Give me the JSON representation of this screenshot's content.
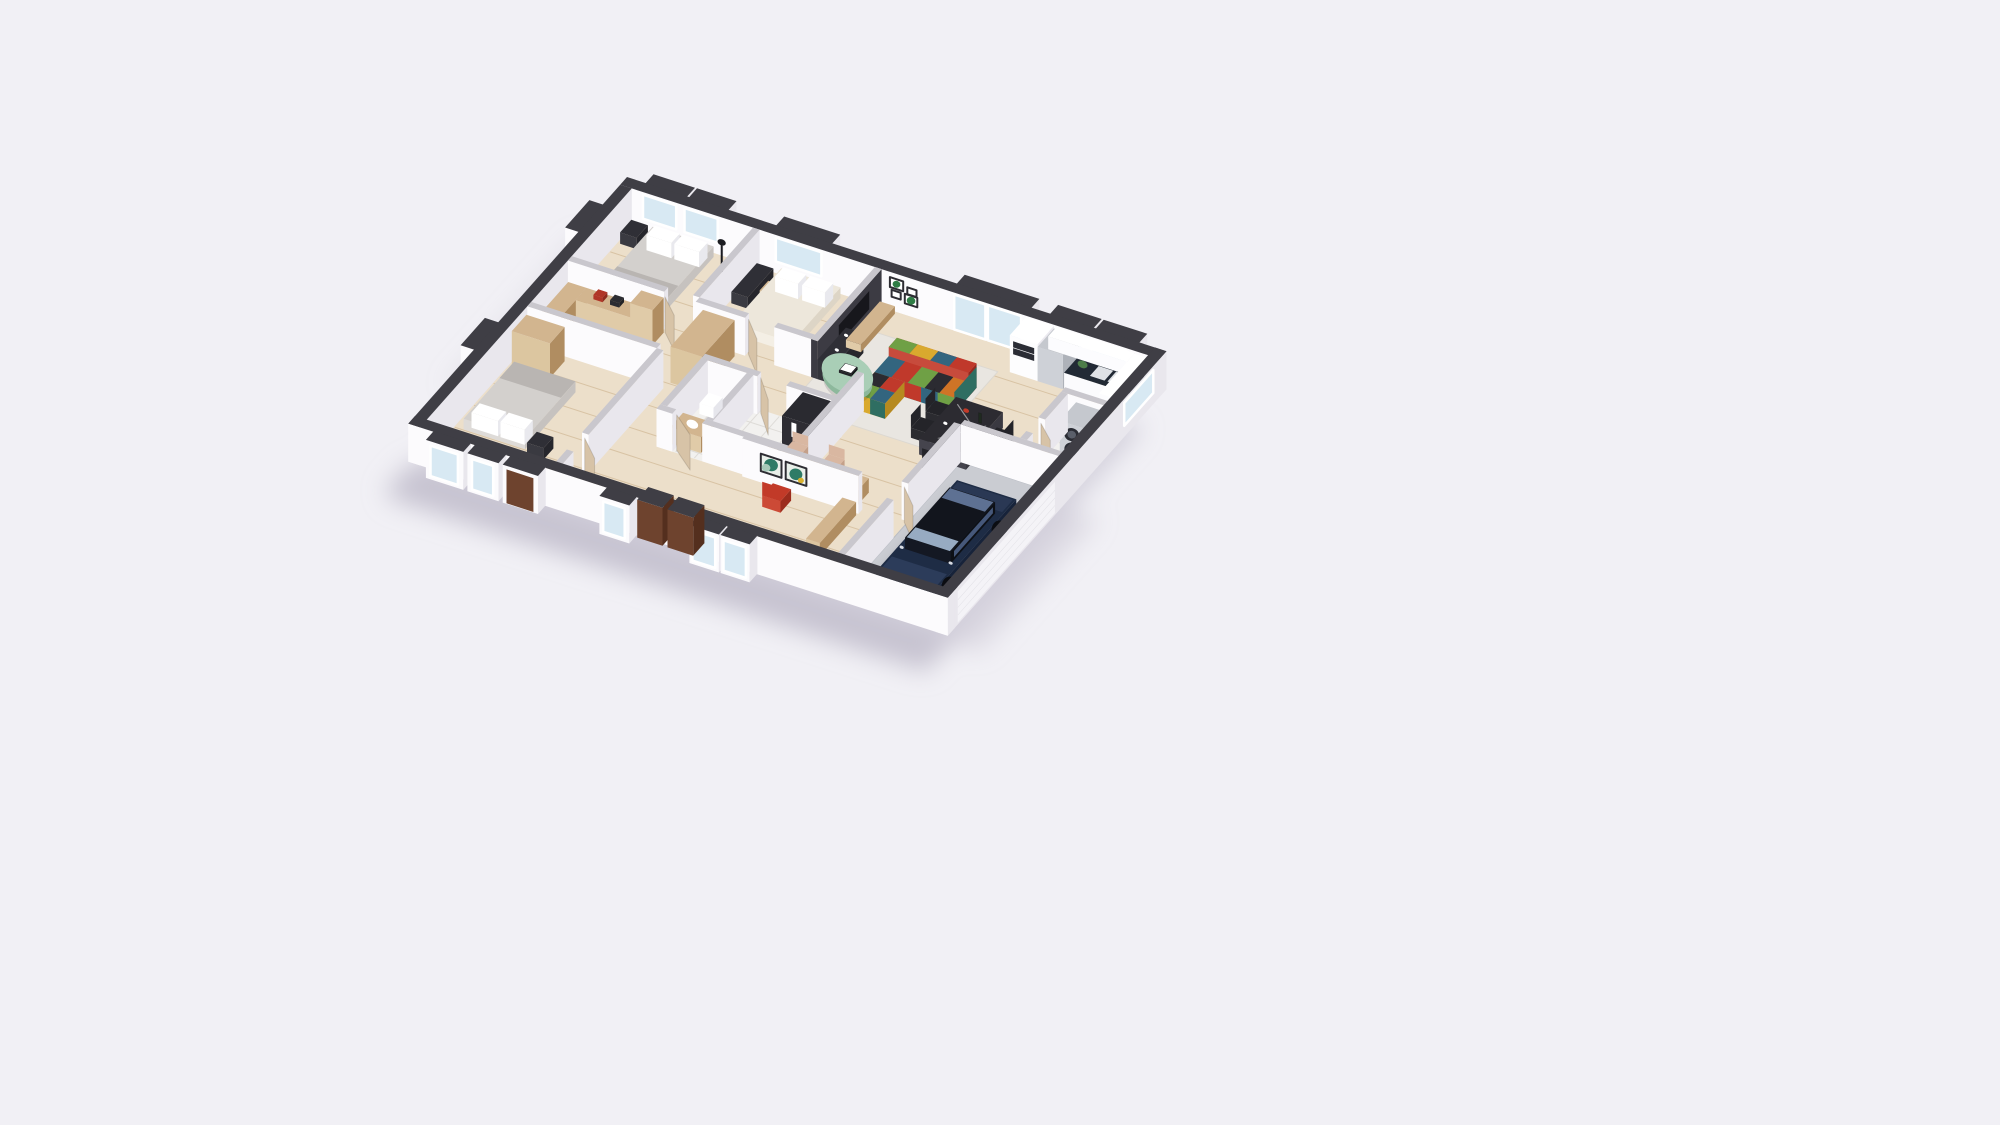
{
  "scene": {
    "type": "3d-floorplan-dollhouse-render",
    "background": "#f1f0f5",
    "light_direction": "upper-right",
    "shadow_color": "#b9b5c6"
  },
  "palette": {
    "bg": "#f1f0f5",
    "shadow": "#b9b5c6",
    "extTop": "#3f3e45",
    "intTop": "#c9c7cd",
    "wallA": "#e9e7ed",
    "wallB": "#fcfbfd",
    "floorWood": "#ecdfca",
    "floorWoodLine": "#d8c3a4",
    "floorTile": "#f2f1ef",
    "tileLine": "#dedcd8",
    "floorGarage": "#caccd2",
    "rug": "#e9e6e1",
    "glass": "#d8e9f3",
    "glassFrame": "#ffffff",
    "tvWall": "#3c3b43",
    "tvScreen": "#17171c",
    "mediaDark": "#2f2f36",
    "wood": "#d2b58f",
    "woodDark": "#b08d61",
    "woodDoor": "#d7c3a7",
    "doorBrown": "#6e432e",
    "doorDark": "#542f1e",
    "duvet": "#d3d0cd",
    "duvetDark": "#b9b5b2",
    "cream": "#ede7db",
    "white": "#ffffff",
    "counterDark": "#222a35",
    "appliance": "#c5c8ce",
    "applianceDark": "#2b2d35",
    "mint": "#a9ceb6",
    "mintDark": "#8db89c",
    "tableTop": "#2c2b31",
    "tableSide": "#3a3941",
    "chairBlack": "#242429",
    "beige": "#d9b7a1",
    "redChair": "#c23a28",
    "carBody": "#1e2c45",
    "carDark": "#12151d",
    "carGlass": "#97abc2",
    "showerDark": "#242329",
    "artTeal": "#2e7b66",
    "artTealLight": "#a7c8b8",
    "artGreen": "#2f7d45",
    "artMustard": "#d8b02e"
  },
  "sofa_colors": [
    "#c0392b",
    "#3f8e80",
    "#d9a92e",
    "#33657f",
    "#6fa045",
    "#2b2b31",
    "#cf7426"
  ],
  "rooms": [
    {
      "name": "bedroom-1",
      "furniture": [
        "double-bed",
        "pillows",
        "blanket",
        "nightstand",
        "floor-lamp"
      ]
    },
    {
      "name": "bedroom-2",
      "furniture": [
        "double-bed",
        "black-desk",
        "wood-chair"
      ]
    },
    {
      "name": "walk-in-closet",
      "furniture": [
        "wood-shelving",
        "tall-wardrobe",
        "storage-boxes"
      ]
    },
    {
      "name": "hallway",
      "furniture": [
        "wardrobe-cabinet",
        "doors"
      ]
    },
    {
      "name": "bathroom",
      "furniture": [
        "black-mosaic-shower",
        "shower-fixture",
        "toilet",
        "wood-vanity"
      ]
    },
    {
      "name": "bedroom-3",
      "furniture": [
        "double-bed",
        "pillows",
        "wardrobe",
        "nightstand"
      ]
    },
    {
      "name": "living-room",
      "furniture": [
        "patchwork-sectional-sofa",
        "round-mint-coffee-table",
        "books",
        "area-rug",
        "tv-media-wall",
        "dark-shelving-unit",
        "wood-cabinet",
        "gallery-wall-frames",
        "sliding-glass-doors"
      ]
    },
    {
      "name": "kitchen",
      "furniture": [
        "oven-tower",
        "fridge",
        "counter-with-double-sink",
        "upper-cabinets",
        "plant"
      ]
    },
    {
      "name": "dining-area",
      "furniture": [
        "dark-stone-table",
        "black-chairs",
        "tableware"
      ]
    },
    {
      "name": "office-nook",
      "furniture": [
        "wood-desk",
        "beige-chairs",
        "red-office-chair",
        "abstract-art-frames",
        "wood-bench"
      ]
    },
    {
      "name": "entrance",
      "furniture": [
        "brown-double-entry-door",
        "sidelight-windows"
      ]
    },
    {
      "name": "laundry-room",
      "furniture": [
        "stacked-washer-dryer"
      ]
    },
    {
      "name": "garage",
      "furniture": [
        "dark-blue-car",
        "sectional-garage-door"
      ]
    }
  ]
}
